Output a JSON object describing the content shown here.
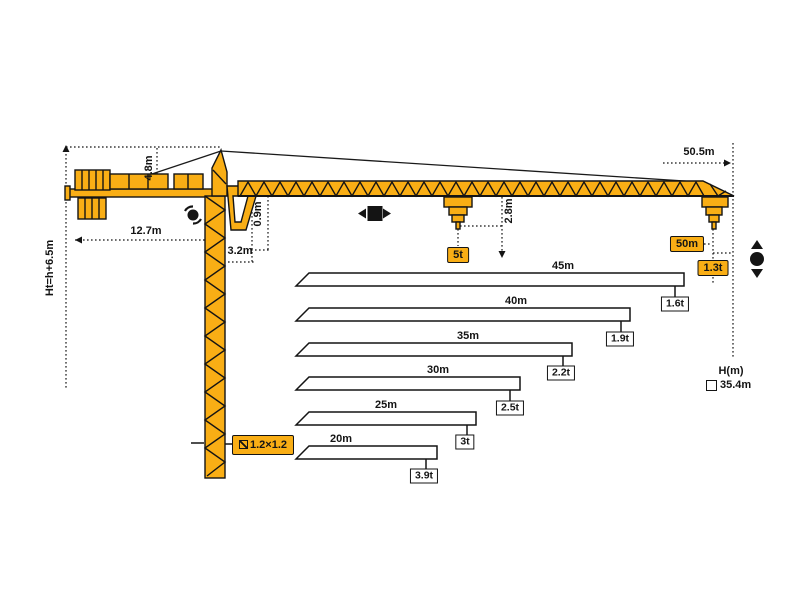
{
  "colors": {
    "crane": "#F9AE15",
    "ink": "#141414",
    "background": "#FFFFFF"
  },
  "dimensions": {
    "total_height": "Ht=h+6.5m",
    "counter_jib_length": "12.7m",
    "tower_head_height": "4.8m",
    "jib_root_offset": "3.2m",
    "jib_depth": "0.9m",
    "trolley_hook_drop": "2.8m",
    "max_working_radius": "50.5m"
  },
  "capacity": {
    "max_load": "5t",
    "tip_radius": "50m",
    "tip_load_at_50m": "1.3t"
  },
  "mast": {
    "section_label": "1.2×1.2"
  },
  "hook_height": {
    "label": "H(m)",
    "value": "35.4m"
  },
  "chart_data": {
    "type": "bar",
    "title": "Tip load capacity by jib length",
    "categories": [
      "45m",
      "40m",
      "35m",
      "30m",
      "25m",
      "20m"
    ],
    "series": [
      {
        "name": "tip load (t)",
        "values": [
          1.6,
          1.9,
          2.2,
          2.5,
          3,
          3.9
        ]
      }
    ],
    "value_labels": [
      "1.6t",
      "1.9t",
      "2.2t",
      "2.5t",
      "3t",
      "3.9t"
    ],
    "full_jib": {
      "length": "50m",
      "overall_radius": "50.5m",
      "tip_load": "1.3t",
      "max_load": "5t"
    }
  },
  "icons": {
    "slewing": "slewing-rotation-icon",
    "trolley": "trolley-travel-icon",
    "hoist": "hook-hoist-icon"
  }
}
